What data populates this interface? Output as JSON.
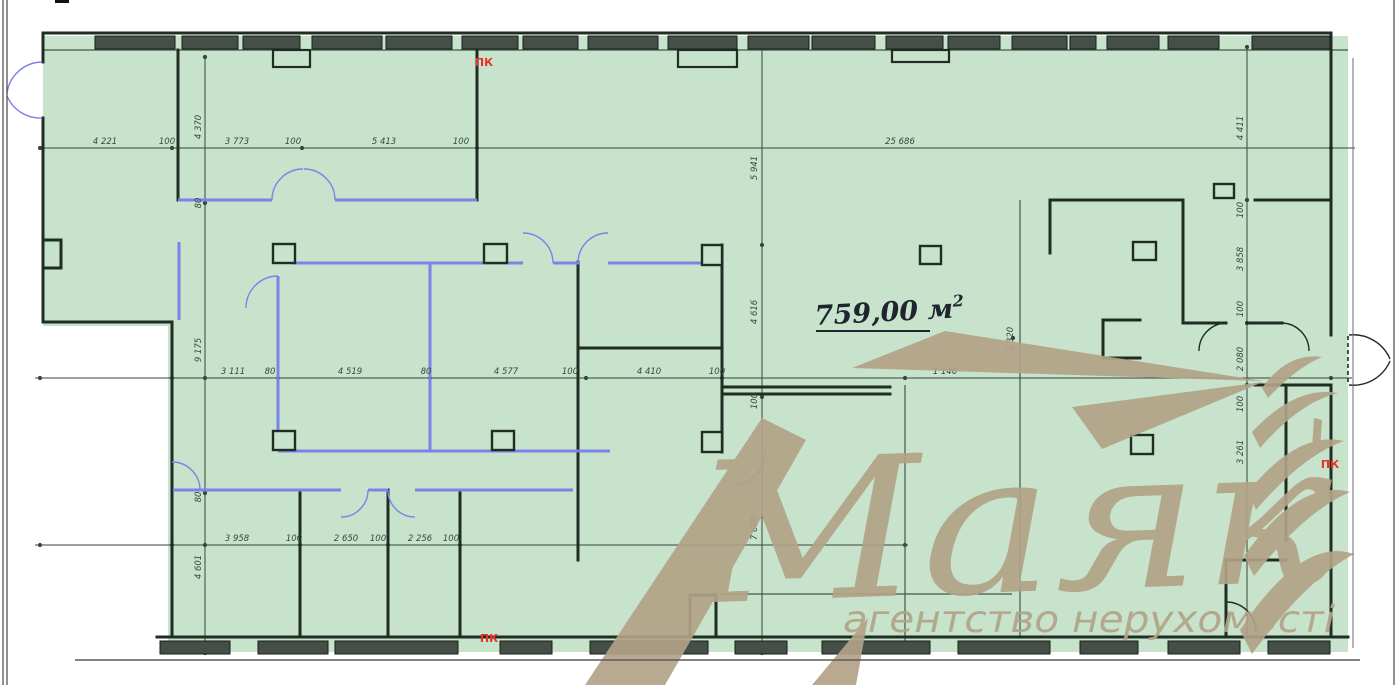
{
  "colors": {
    "green": "#c7e3cc",
    "wall": "#1f2d23",
    "window": "#454e47",
    "blue": "#7d82e8",
    "dim": "#37463b",
    "red": "#e8322a",
    "tan": "#b2a287",
    "frame": "#454545",
    "ground": "#5a5a5a",
    "area_text": "#20242e"
  },
  "area_label": {
    "text": "759,00 м",
    "sup": "2",
    "x": 815,
    "y": 322
  },
  "watermark": {
    "brand": "Маяк",
    "tagline": "агентство нерухомості"
  },
  "pk": [
    {
      "label": "ПК",
      "x": 484,
      "y": 66
    },
    {
      "label": "ПК",
      "x": 489,
      "y": 642
    },
    {
      "label": "ПК",
      "x": 1330,
      "y": 468
    }
  ],
  "dims_h": [
    {
      "text": "4 221",
      "x": 105,
      "y": 144
    },
    {
      "text": "100",
      "x": 167,
      "y": 144
    },
    {
      "text": "3 773",
      "x": 237,
      "y": 144
    },
    {
      "text": "100",
      "x": 293,
      "y": 144
    },
    {
      "text": "5 413",
      "x": 384,
      "y": 144
    },
    {
      "text": "100",
      "x": 461,
      "y": 144
    },
    {
      "text": "25 686",
      "x": 900,
      "y": 144
    },
    {
      "text": "3 111",
      "x": 233,
      "y": 374
    },
    {
      "text": "80",
      "x": 270,
      "y": 374
    },
    {
      "text": "4 519",
      "x": 350,
      "y": 374
    },
    {
      "text": "80",
      "x": 426,
      "y": 374
    },
    {
      "text": "4 577",
      "x": 506,
      "y": 374
    },
    {
      "text": "100",
      "x": 570,
      "y": 374
    },
    {
      "text": "4 410",
      "x": 649,
      "y": 374
    },
    {
      "text": "100",
      "x": 717,
      "y": 374
    },
    {
      "text": "1 146",
      "x": 945,
      "y": 374
    },
    {
      "text": "3 958",
      "x": 237,
      "y": 541
    },
    {
      "text": "100",
      "x": 294,
      "y": 541
    },
    {
      "text": "2 650",
      "x": 346,
      "y": 541
    },
    {
      "text": "100",
      "x": 378,
      "y": 541
    },
    {
      "text": "2 256",
      "x": 420,
      "y": 541
    },
    {
      "text": "100",
      "x": 451,
      "y": 541
    }
  ],
  "dims_v": [
    {
      "text": "4 370",
      "x": 201,
      "y": 127
    },
    {
      "text": "80",
      "x": 201,
      "y": 203
    },
    {
      "text": "9 175",
      "x": 201,
      "y": 350
    },
    {
      "text": "80",
      "x": 201,
      "y": 497
    },
    {
      "text": "4 601",
      "x": 201,
      "y": 567
    },
    {
      "text": "5 941",
      "x": 757,
      "y": 168
    },
    {
      "text": "4 616",
      "x": 757,
      "y": 312
    },
    {
      "text": "100",
      "x": 757,
      "y": 401
    },
    {
      "text": "7 650",
      "x": 757,
      "y": 528
    },
    {
      "text": "4 411",
      "x": 1243,
      "y": 128
    },
    {
      "text": "100",
      "x": 1243,
      "y": 210
    },
    {
      "text": "3 858",
      "x": 1243,
      "y": 259
    },
    {
      "text": "100",
      "x": 1243,
      "y": 309
    },
    {
      "text": "2 080",
      "x": 1243,
      "y": 359
    },
    {
      "text": "100",
      "x": 1243,
      "y": 404
    },
    {
      "text": "3 261",
      "x": 1243,
      "y": 452
    },
    {
      "text": "1 320",
      "x": 1013,
      "y": 339
    }
  ],
  "geometry": {
    "green_poly": "43,36 1348,36 1348,652 168,652 168,326 43,326",
    "frame_lines": [
      [
        3,
        0,
        3,
        685
      ],
      [
        7,
        0,
        7,
        685
      ],
      [
        1394,
        0,
        1394,
        685
      ]
    ],
    "corner_tick": [
      55,
      0,
      14,
      3
    ],
    "ground_line": [
      75,
      660,
      1360,
      660
    ],
    "right_inner_line": [
      1353,
      58,
      1353,
      648
    ],
    "walls": [
      [
        43,
        33,
        1331,
        33
      ],
      [
        1331,
        33,
        1331,
        335
      ],
      [
        1331,
        385,
        1331,
        637
      ],
      [
        157,
        637,
        1348,
        637
      ],
      [
        43,
        33,
        43,
        62
      ],
      [
        43,
        118,
        43,
        322
      ],
      [
        43,
        322,
        172,
        322
      ],
      [
        172,
        322,
        172,
        637
      ],
      [
        43,
        240,
        61,
        240
      ],
      [
        61,
        240,
        61,
        268
      ],
      [
        43,
        268,
        61,
        268
      ],
      [
        178,
        50,
        178,
        200
      ],
      [
        477,
        50,
        477,
        200
      ],
      [
        578,
        262,
        578,
        560
      ],
      [
        722,
        245,
        722,
        452
      ],
      [
        578,
        348,
        722,
        348
      ],
      [
        300,
        490,
        300,
        637
      ],
      [
        388,
        490,
        388,
        637
      ],
      [
        460,
        490,
        460,
        637
      ],
      [
        690,
        595,
        690,
        637
      ],
      [
        716,
        595,
        716,
        637
      ],
      [
        690,
        595,
        716,
        595
      ],
      [
        1050,
        200,
        1183,
        200
      ],
      [
        1050,
        200,
        1050,
        253
      ],
      [
        1183,
        200,
        1183,
        323
      ],
      [
        1255,
        200,
        1331,
        200
      ],
      [
        1183,
        323,
        1226,
        323
      ],
      [
        1247,
        323,
        1282,
        323
      ],
      [
        1103,
        320,
        1140,
        320
      ],
      [
        1103,
        320,
        1103,
        358
      ],
      [
        1103,
        358,
        1140,
        358
      ],
      [
        1255,
        385,
        1331,
        385
      ],
      [
        1286,
        385,
        1286,
        540
      ],
      [
        1226,
        560,
        1226,
        637
      ],
      [
        1226,
        560,
        1286,
        560
      ],
      [
        722,
        387,
        890,
        387
      ],
      [
        722,
        394,
        890,
        394
      ]
    ],
    "thin_lines": [
      [
        43,
        50,
        1348,
        50
      ],
      [
        1020,
        200,
        1020,
        637
      ],
      [
        720,
        594,
        1012,
        594
      ],
      [
        905,
        385,
        905,
        650
      ]
    ],
    "blue_walls": [
      [
        178,
        200,
        272,
        200
      ],
      [
        335,
        200,
        477,
        200
      ],
      [
        179,
        242,
        179,
        320
      ],
      [
        292,
        263,
        523,
        263
      ],
      [
        553,
        263,
        580,
        263
      ],
      [
        608,
        263,
        701,
        263
      ],
      [
        278,
        276,
        278,
        451
      ],
      [
        430,
        263,
        430,
        451
      ],
      [
        278,
        451,
        610,
        451
      ],
      [
        173,
        490,
        341,
        490
      ],
      [
        368,
        490,
        388,
        490
      ],
      [
        415,
        490,
        573,
        490
      ]
    ],
    "blue_arcs": [
      "M272,200 A31,31 0 0 1 303,169",
      "M335,200 A31,31 0 0 0 304,169",
      "M278,276 A32,32 0 0 0 246,308",
      "M553,263 A30,30 0 0 0 523,233",
      "M578,263 A30,30 0 0 1 608,233",
      "M368,490 A27,27 0 0 1 341,517",
      "M388,490 A27,27 0 0 0 415,517",
      "M172,462 A28,28 0 0 1 200,490",
      "M765,452 A33,33 0 0 1 732,485",
      "M42,62 A36,36 0 0 0 7,93",
      "M42,118 A36,36 0 0 1 7,96"
    ],
    "black_arcs": [
      "M1226,323 A28,28 0 0 0 1199,351",
      "M1282,323 A28,28 0 0 1 1309,351",
      "M1226,602 A30,30 0 0 1 1256,632",
      "M1349,335 A40,40 0 0 1 1390,359",
      "M1349,385 A40,40 0 0 0 1390,361"
    ],
    "dashed_lines": [
      [
        1348,
        336,
        1348,
        384
      ]
    ],
    "columns": [
      [
        273,
        244,
        22,
        19
      ],
      [
        484,
        244,
        23,
        19
      ],
      [
        920,
        246,
        21,
        18
      ],
      [
        1133,
        242,
        23,
        18
      ],
      [
        273,
        431,
        22,
        19
      ],
      [
        492,
        431,
        22,
        19
      ],
      [
        1131,
        435,
        22,
        19
      ],
      [
        702,
        245,
        20,
        20
      ],
      [
        702,
        432,
        20,
        20
      ],
      [
        1214,
        184,
        20,
        14
      ]
    ],
    "piers": [
      [
        273,
        50,
        37,
        17
      ],
      [
        678,
        50,
        59,
        17
      ],
      [
        892,
        50,
        57,
        12
      ]
    ],
    "windows_top": [
      [
        95,
        80
      ],
      [
        182,
        56
      ],
      [
        243,
        57
      ],
      [
        312,
        70
      ],
      [
        386,
        66
      ],
      [
        462,
        56
      ],
      [
        523,
        55
      ],
      [
        588,
        70
      ],
      [
        668,
        69
      ],
      [
        748,
        61
      ],
      [
        812,
        63
      ],
      [
        886,
        57
      ],
      [
        948,
        52
      ],
      [
        1012,
        55
      ],
      [
        1070,
        26
      ],
      [
        1107,
        52
      ],
      [
        1168,
        51
      ],
      [
        1252,
        78
      ]
    ],
    "windows_top_y": 36,
    "windows_h": 13,
    "windows_bottom": [
      [
        160,
        70
      ],
      [
        258,
        70
      ],
      [
        335,
        123
      ],
      [
        500,
        52
      ],
      [
        590,
        118
      ],
      [
        735,
        52
      ],
      [
        822,
        108
      ],
      [
        958,
        92
      ],
      [
        1080,
        58
      ],
      [
        1168,
        72
      ],
      [
        1268,
        62
      ]
    ],
    "windows_bottom_y": 641,
    "dim_lines": [
      [
        38,
        148,
        1355,
        148
      ],
      [
        35,
        378,
        1352,
        378
      ],
      [
        35,
        545,
        908,
        545
      ],
      [
        205,
        57,
        205,
        653
      ],
      [
        762,
        47,
        762,
        653
      ],
      [
        1247,
        47,
        1247,
        637
      ]
    ],
    "dots": [
      [
        40,
        148
      ],
      [
        172,
        148
      ],
      [
        302,
        148
      ],
      [
        477,
        148
      ],
      [
        1331,
        148
      ],
      [
        40,
        378
      ],
      [
        172,
        378
      ],
      [
        278,
        378
      ],
      [
        430,
        378
      ],
      [
        586,
        378
      ],
      [
        722,
        378
      ],
      [
        905,
        378
      ],
      [
        1331,
        378
      ],
      [
        40,
        545
      ],
      [
        172,
        545
      ],
      [
        300,
        545
      ],
      [
        388,
        545
      ],
      [
        460,
        545
      ],
      [
        905,
        545
      ],
      [
        205,
        57
      ],
      [
        205,
        203
      ],
      [
        205,
        378
      ],
      [
        205,
        493
      ],
      [
        205,
        545
      ],
      [
        205,
        653
      ],
      [
        762,
        47
      ],
      [
        762,
        245
      ],
      [
        762,
        397
      ],
      [
        762,
        653
      ],
      [
        1247,
        47
      ],
      [
        1247,
        200
      ],
      [
        1247,
        323
      ],
      [
        1247,
        385
      ],
      [
        1013,
        338
      ]
    ],
    "area_underline": [
      816,
      331,
      930,
      331
    ],
    "beams": [
      "762,418 806,440 665,685 585,685",
      "812,685 868,618 856,685",
      "852,368 1263,381 945,331",
      "1072,407 1263,382 1102,449",
      "1314,418 1322,420 1320,450 1312,448"
    ],
    "tower": [
      "M1262,388 Q1288,352 1322,357 Q1296,368 1268,398 Z",
      "M1252,432 Q1296,385 1338,393 Q1300,402 1260,448 Z",
      "M1248,492 Q1298,430 1344,441 Q1302,456 1256,510 Z",
      "M1244,556 Q1300,478 1350,492 Q1304,512 1254,576 Z",
      "M1240,630 Q1302,536 1354,554 Q1306,580 1252,654 Z"
    ],
    "brand_pos": {
      "x": 693,
      "y": 592,
      "size": 195,
      "length": 640
    },
    "tag_pos": {
      "x": 843,
      "y": 632,
      "size": 37,
      "length": 492
    }
  }
}
